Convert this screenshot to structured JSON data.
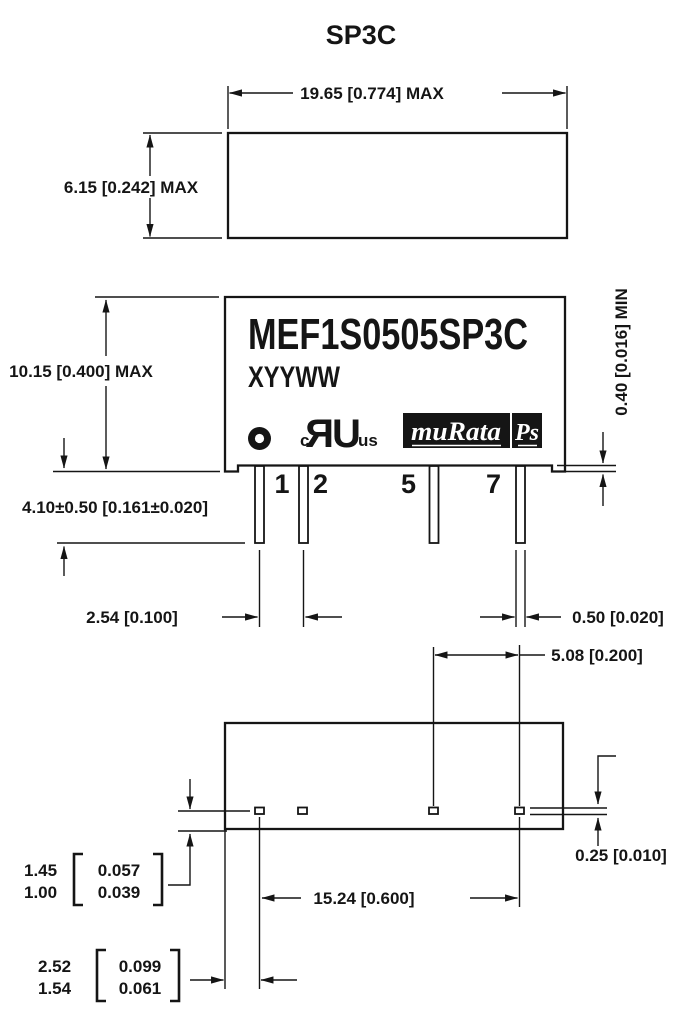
{
  "title": "SP3C",
  "colors": {
    "ink": "#151515",
    "paper": "#ffffff"
  },
  "top_view": {
    "dim_width": "19.65 [0.774] MAX",
    "dim_height": "6.15 [0.242] MAX"
  },
  "front_view": {
    "part_number": "MEF1S0505SP3C",
    "date_code": "XYYWW",
    "ul_mark": {
      "c": "c",
      "monogram": "UR",
      "us": "us"
    },
    "murata_logo": "muRata",
    "ps_logo": "Ps",
    "pins": [
      "1",
      "2",
      "5",
      "7"
    ],
    "dim_body_height": "10.15 [0.400] MAX",
    "dim_pin_length": "4.10±0.50 [0.161±0.020]",
    "dim_pin_pitch": "2.54 [0.100]",
    "dim_pin_width": "0.50 [0.020]",
    "dim_standoff": "0.40 [0.016] MIN"
  },
  "bottom_view": {
    "dim_pin_gap": "5.08 [0.200]",
    "dim_row_span": "15.24 [0.600]",
    "dim_pin_thickness": "0.25 [0.010]",
    "dim_pad_to_edge": {
      "mm_max": "1.45",
      "mm_min": "1.00",
      "in_max": "0.057",
      "in_min": "0.039"
    },
    "dim_pin1_to_edge": {
      "mm_max": "2.52",
      "mm_min": "1.54",
      "in_max": "0.099",
      "in_min": "0.061"
    }
  }
}
